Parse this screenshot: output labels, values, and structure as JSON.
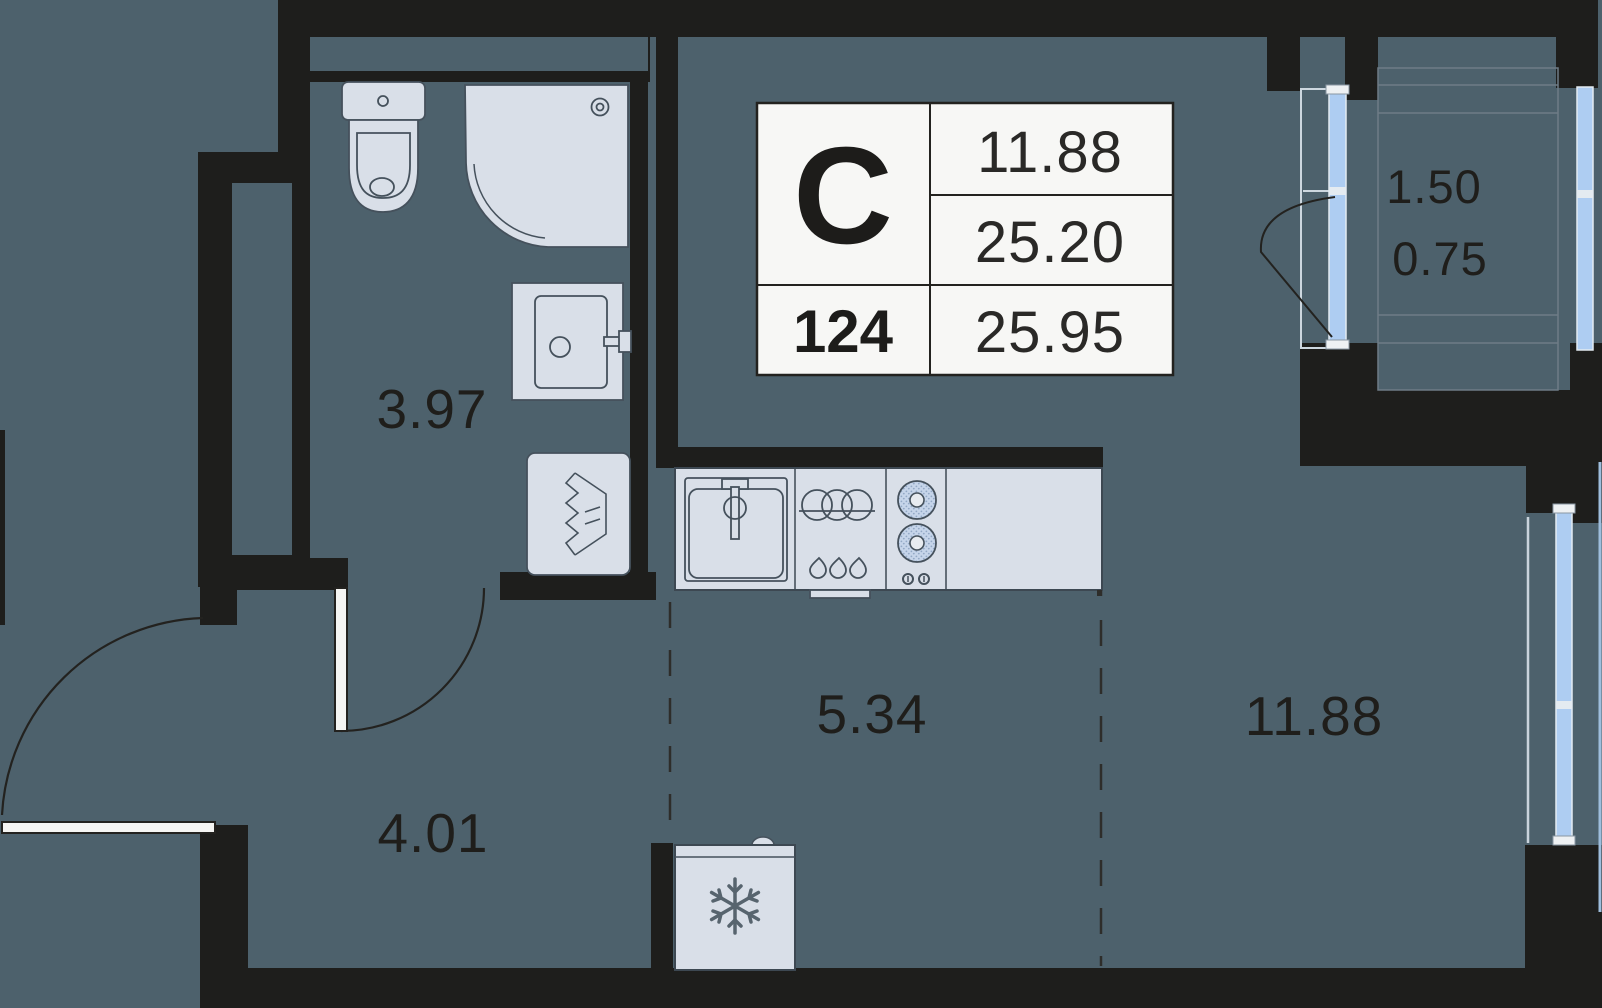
{
  "info_card": {
    "type_letter": "С",
    "unit_number": "124",
    "room_area": "11.88",
    "living_area": "25.20",
    "total_area": "25.95"
  },
  "rooms": {
    "bathroom_area": "3.97",
    "hallway_area": "4.01",
    "kitchen_area": "5.34",
    "living_room_area": "11.88",
    "balcony_area_full": "1.50",
    "balcony_area_reduced": "0.75"
  },
  "colors": {
    "floor": "#4d616c",
    "wall": "#1e1e1c",
    "fixture_fill": "#d9dfe8",
    "fixture_stroke": "#45515c",
    "window_glass": "#aecdf2",
    "card_bg": "#f7f7f5",
    "label_text": "#1f1e1b"
  }
}
